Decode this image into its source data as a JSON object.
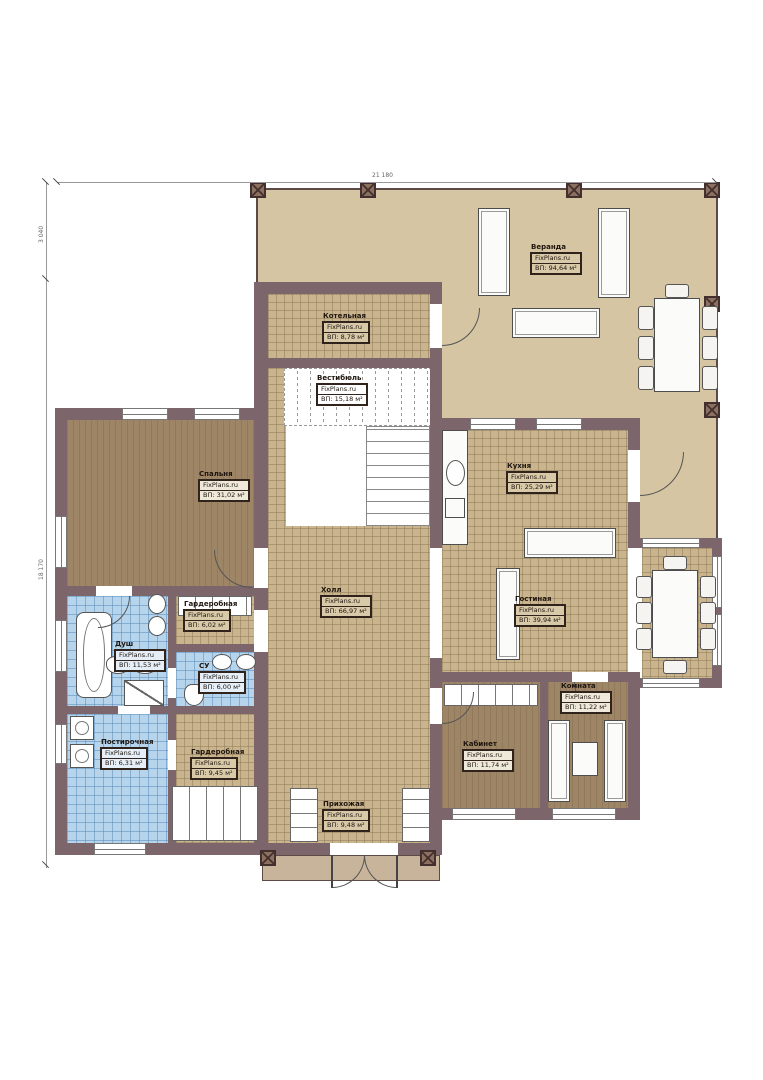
{
  "brand": "FixPlans.ru",
  "dimensions": {
    "top": "21 180",
    "left_top": "3 040",
    "left_bottom": "18 170"
  },
  "rooms": [
    {
      "name": "Веранда",
      "area": "ВП: 94,64 м²"
    },
    {
      "name": "Котельная",
      "area": "ВП: 8,78 м²"
    },
    {
      "name": "Вестибюль",
      "area": "ВП: 15,18 м²"
    },
    {
      "name": "Спальня",
      "area": "ВП: 31,02 м²"
    },
    {
      "name": "Кухня",
      "area": "ВП: 25,29 м²"
    },
    {
      "name": "Холл",
      "area": "ВП: 66,97 м²"
    },
    {
      "name": "Гостиная",
      "area": "ВП: 39,94 м²"
    },
    {
      "name": "Гардеробная",
      "area": "ВП: 6,02 м²"
    },
    {
      "name": "Душ",
      "area": "ВП: 11,53 м²"
    },
    {
      "name": "СУ",
      "area": "ВП: 6,00 м²"
    },
    {
      "name": "Постирочная",
      "area": "ВП: 6,31 м²"
    },
    {
      "name": "Гардеробная",
      "area": "ВП: 9,45 м²"
    },
    {
      "name": "Прихожая",
      "area": "ВП: 9,48 м²"
    },
    {
      "name": "Кабинет",
      "area": "ВП: 11,74 м²"
    },
    {
      "name": "Комната",
      "area": "ВП: 11,22 м²"
    }
  ],
  "colors": {
    "wall": "#7c656b",
    "veranda": "#d5c5a3",
    "tile": "#c9b48d",
    "wood": "#9d8565",
    "wet": "#b7d4ed"
  }
}
